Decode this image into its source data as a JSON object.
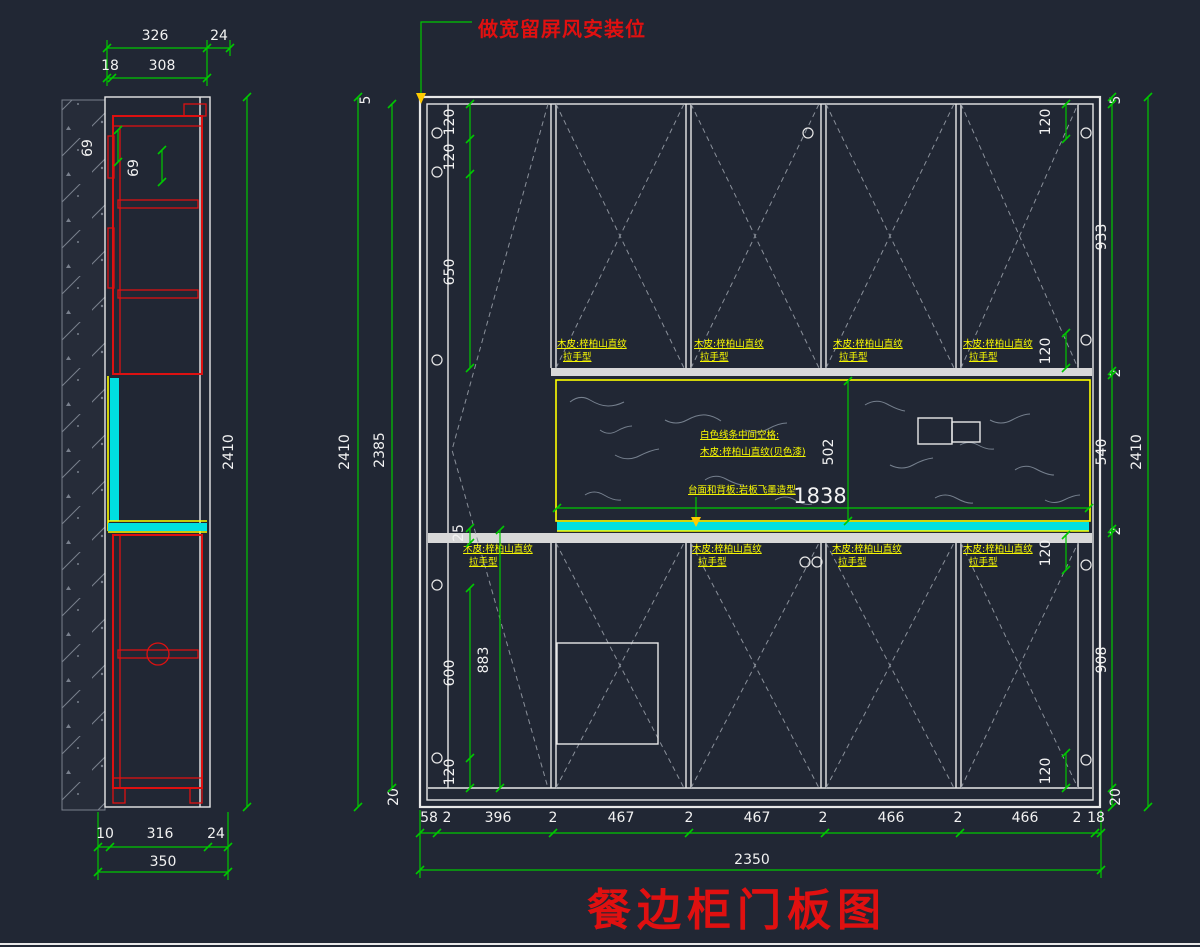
{
  "title": "餐边柜门板图",
  "top_note": "做宽留屏风安装位",
  "colors": {
    "background": "#212734",
    "dimension_green": "#00c800",
    "outline_white": "#e8e8e8",
    "cabinet_red": "#dd1111",
    "label_yellow": "#ffff00",
    "counter_cyan": "#00e0e0",
    "title_red": "#e01010"
  },
  "side_view": {
    "dim_top_326": "326",
    "dim_top_24": "24",
    "dim_top_18": "18",
    "dim_top_308": "308",
    "dim_69_a": "69",
    "dim_69_b": "69",
    "dim_height_2410": "2410",
    "dim_bottom_10": "10",
    "dim_bottom_316": "316",
    "dim_bottom_24": "24",
    "dim_bottom_350": "350"
  },
  "elevation": {
    "left": {
      "d5": "5",
      "d2385": "2385",
      "d2410": "2410",
      "d20": "20",
      "d120a": "120",
      "d120b": "120",
      "d650": "650",
      "d25": "25",
      "d600": "600",
      "d883": "883",
      "d120c": "120"
    },
    "right": {
      "d5": "5",
      "d933": "933",
      "d2a": "2",
      "d540": "540",
      "d2b": "2",
      "d908": "908",
      "d20": "20",
      "d2410": "2410",
      "d120_top": "120",
      "d120_mid_upper": "120",
      "d120_mid_lower": "120",
      "d120_bottom": "120"
    },
    "niche": {
      "d502": "502",
      "d1838": "1838",
      "note1": "白色线条中间空格:",
      "note2": "木皮:梓柏山直纹(贝色漆)",
      "note3": "台面和背板:岩板飞墨造型"
    },
    "door_label": {
      "line1": "木皮:梓柏山直纹",
      "line2": "拉手型"
    },
    "bottom_chain": [
      "58",
      "2",
      "396",
      "2",
      "467",
      "2",
      "467",
      "2",
      "466",
      "2",
      "466",
      "2",
      "18"
    ],
    "bottom_total": "2350"
  }
}
